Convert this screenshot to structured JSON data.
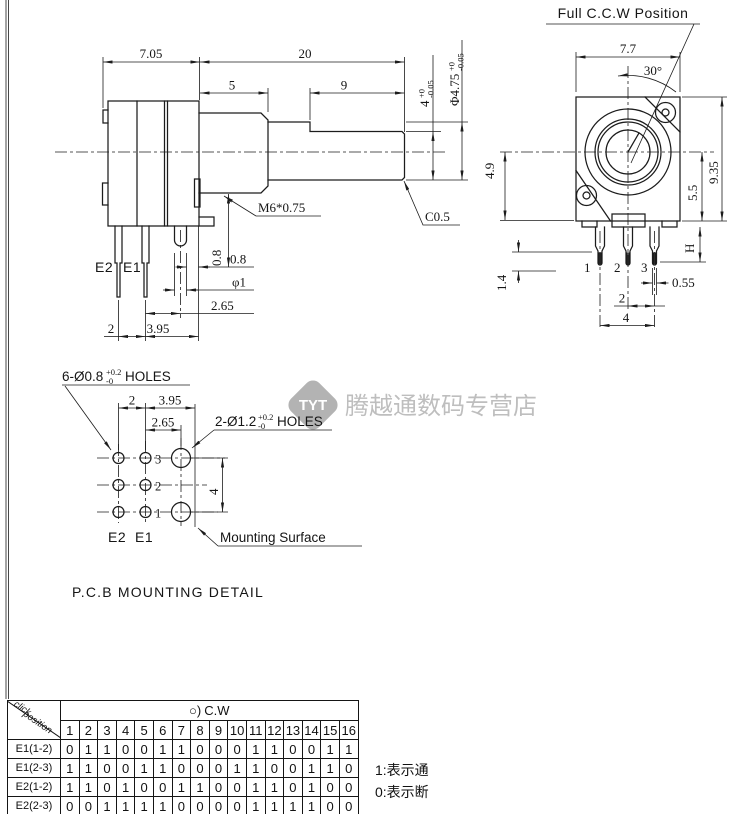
{
  "side_view": {
    "dims": {
      "width_705": "7.05",
      "length_20": "20",
      "bushing_5": "5",
      "flat_9": "9",
      "flat_height": "4",
      "flat_tol_top": "+0",
      "flat_tol_bot": "-0.05",
      "shaft_dia": "Φ4.75",
      "shaft_tol_top": "+0",
      "shaft_tol_bot": "-0.05",
      "thread": "M6*0.75",
      "chamfer": "C0.5",
      "v08": "0.8",
      "h08": "0.8",
      "pin_dia": "φ1",
      "d265": "2.65",
      "d2": "2",
      "d395": "3.95"
    },
    "labels": {
      "e2": "E2",
      "e1": "E1"
    }
  },
  "front_view": {
    "title": "Full C.C.W Position",
    "dims": {
      "width": "7.7",
      "angle": "30°",
      "left": "4.9",
      "height": "9.35",
      "right": "5.5",
      "pin_h": "H",
      "d14": "1.4",
      "d055": "0.55",
      "d2": "2",
      "d4": "4"
    },
    "pins": {
      "p1": "1",
      "p2": "2",
      "p3": "3"
    }
  },
  "pcb_detail": {
    "holes6": {
      "prefix": "6-Ø0.8",
      "tol_top": "+0.2",
      "tol_bot": "-0",
      "suffix": "HOLES"
    },
    "holes2": {
      "prefix": "2-Ø1.2",
      "tol_top": "+0.2",
      "tol_bot": "-0",
      "suffix": "HOLES"
    },
    "dims": {
      "d2": "2",
      "d395": "3.95",
      "d265": "2.65",
      "d4": "4"
    },
    "rows": {
      "r3": "3",
      "r2": "2",
      "r1": "1"
    },
    "labels": {
      "e2": "E2",
      "e1": "E1"
    },
    "mounting_surface": "Mounting Surface",
    "title": "P.C.B MOUNTING DETAIL"
  },
  "watermark": {
    "logo": "TYT",
    "shop": "腾越通数码专营店",
    "logo_color": "#a6a6a6",
    "text_color": "#b3b3b3"
  },
  "table": {
    "corner": {
      "line1": "click",
      "line2": "position"
    },
    "cw_symbol": "○)",
    "cw_label": "C.W",
    "columns": [
      "1",
      "2",
      "3",
      "4",
      "5",
      "6",
      "7",
      "8",
      "9",
      "10",
      "11",
      "12",
      "13",
      "14",
      "15",
      "16"
    ],
    "rows": [
      {
        "label": "E1(1-2)",
        "values": [
          "0",
          "1",
          "1",
          "0",
          "0",
          "1",
          "1",
          "0",
          "0",
          "0",
          "1",
          "1",
          "0",
          "0",
          "1",
          "1"
        ]
      },
      {
        "label": "E1(2-3)",
        "values": [
          "1",
          "1",
          "0",
          "0",
          "1",
          "1",
          "0",
          "0",
          "0",
          "1",
          "1",
          "0",
          "0",
          "1",
          "1",
          "0"
        ]
      },
      {
        "label": "E2(1-2)",
        "values": [
          "1",
          "1",
          "0",
          "1",
          "0",
          "0",
          "1",
          "1",
          "0",
          "0",
          "1",
          "1",
          "0",
          "1",
          "0",
          "0"
        ]
      },
      {
        "label": "E2(2-3)",
        "values": [
          "0",
          "0",
          "1",
          "1",
          "1",
          "1",
          "0",
          "0",
          "0",
          "0",
          "1",
          "1",
          "1",
          "1",
          "0",
          "0"
        ]
      }
    ],
    "notes": [
      "1:表示通",
      "0:表示断"
    ]
  }
}
